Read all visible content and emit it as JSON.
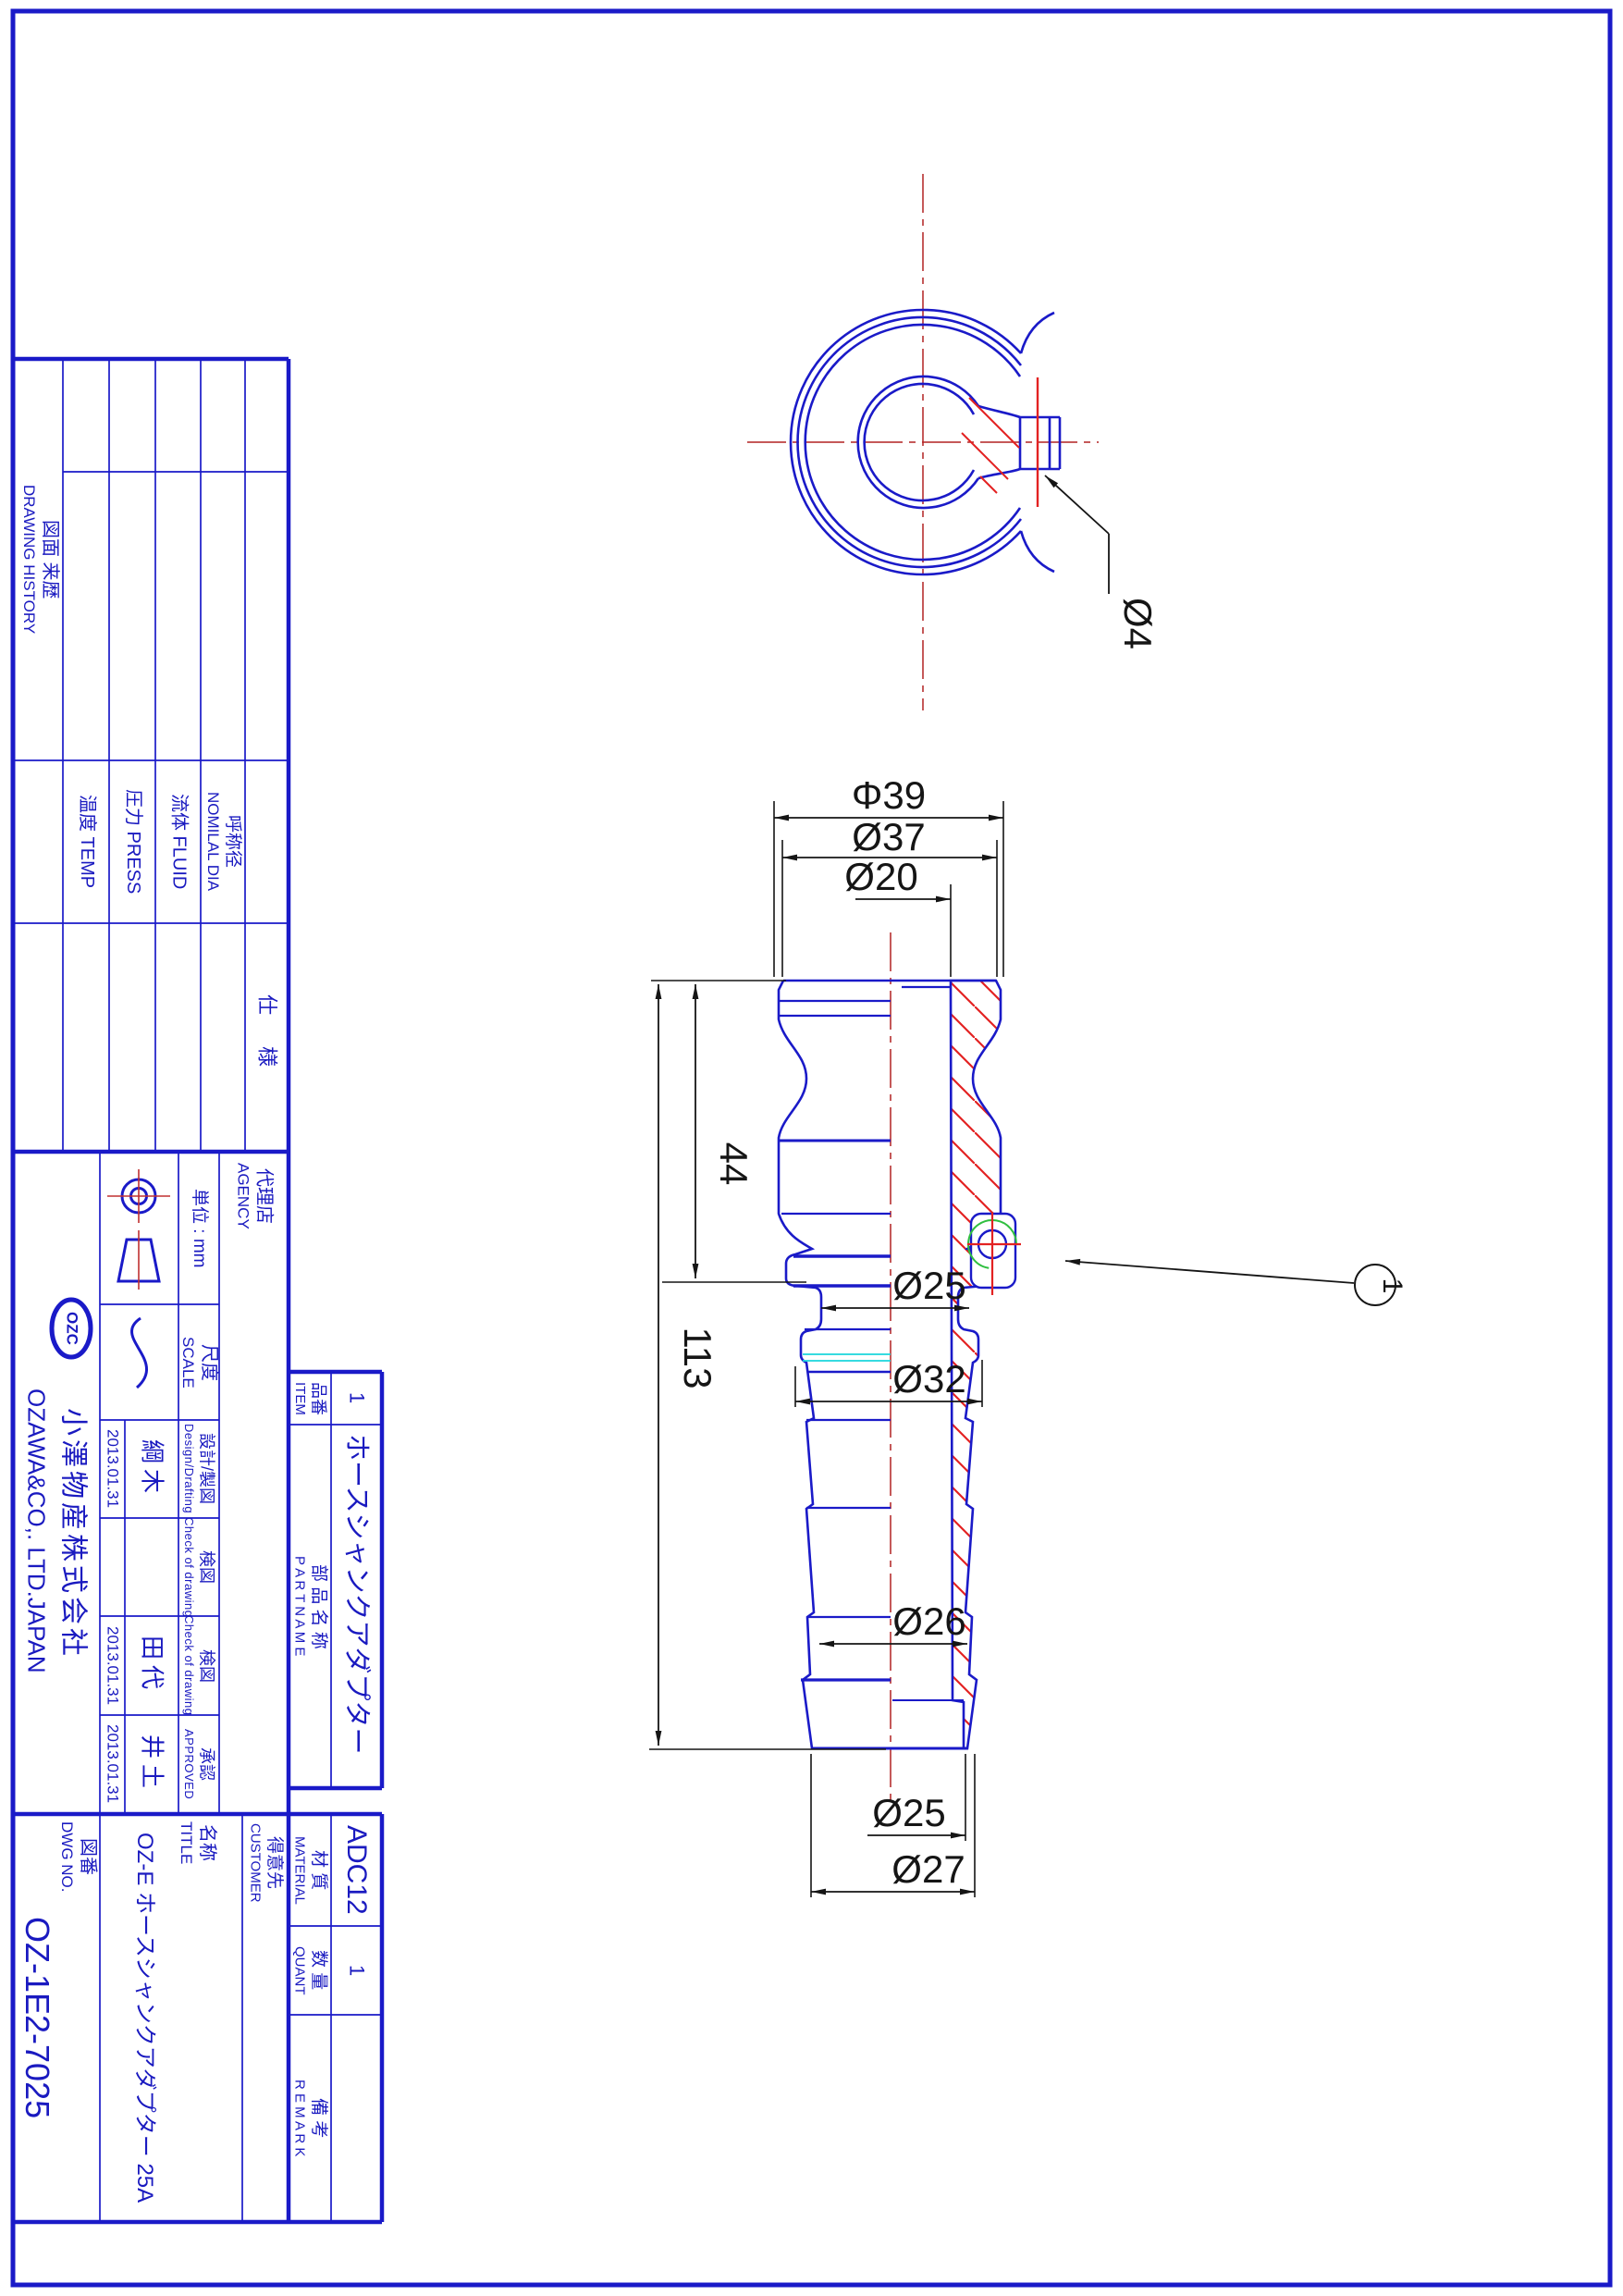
{
  "colors": {
    "line_blue": "#1a1ac8",
    "text_blue": "#1a1ac0",
    "dim_black": "#151515",
    "hatch_red": "#e32222",
    "center_red": "#b22222",
    "accent_cyan": "#19d6dc",
    "accent_green": "#2fbf3f"
  },
  "history": {
    "label_jp": "図面 来歴",
    "label_en": "DRAWING HISTORY"
  },
  "specs": {
    "header": "仕 様",
    "temp": "温度 TEMP",
    "press": "圧力 PRESS",
    "fluid": "流体 FLUID",
    "nominal_jp": "呼称径",
    "nominal_en": "NOMILAL DIA"
  },
  "agency": {
    "jp": "代理店",
    "en": "AGENCY"
  },
  "company": {
    "logo": "OZC",
    "name_jp": "小澤物産株式会社",
    "name_en": "OZAWA&CO,. LTD.JAPAN"
  },
  "unit": {
    "label": "単位 : mm"
  },
  "scale": {
    "jp": "尺度",
    "en": "SCALE"
  },
  "approval": {
    "design": {
      "label_jp": "設計/製図",
      "label_en": "Design/Drafting",
      "name": "綱木",
      "date": "2013.01.31"
    },
    "check1": {
      "label_jp": "検図",
      "label_en": "Check of drawing",
      "name": "",
      "date": ""
    },
    "check2": {
      "label_jp": "検図",
      "label_en": "Check of drawing",
      "name": "田代",
      "date": "2013.01.31"
    },
    "approved": {
      "label_jp": "承認",
      "label_en": "APPROVED",
      "name": "井土",
      "date": "2013.01.31"
    }
  },
  "dwg": {
    "label_jp": "図番",
    "label_en": "DWG NO.",
    "value": "OZ-1E2-7025"
  },
  "title": {
    "label_jp": "名称",
    "label_en": "TITLE",
    "value": "OZ-E ホースシャンクアダプター 25A"
  },
  "customer": {
    "jp": "得意先",
    "en": "CUSTOMER"
  },
  "parts": {
    "item_label_jp": "品番",
    "item_label_en": "ITEM",
    "item_value": "1",
    "name_label_jp": "部 品 名 称",
    "name_label_en": "P A R T N A M E",
    "name_value": "ホースシャンクアダプター",
    "material_label_jp": "材 質",
    "material_label_en": "MATERIAL",
    "material_value": "ADC12",
    "quant_label_jp": "数 量",
    "quant_label_en": "QUANT",
    "quant_value": "1",
    "remark_label_jp": "備 考",
    "remark_label_en": "R E M A R K"
  },
  "dims": {
    "d39": "Φ39",
    "d37": "Ø37",
    "d20": "Ø20",
    "d44": "44",
    "d113": "113",
    "d25": "Ø25",
    "d32": "Ø32",
    "d26": "Ø26",
    "d25b": "Ø25",
    "d27": "Ø27",
    "d4": "Ø4",
    "balloon": "1"
  }
}
